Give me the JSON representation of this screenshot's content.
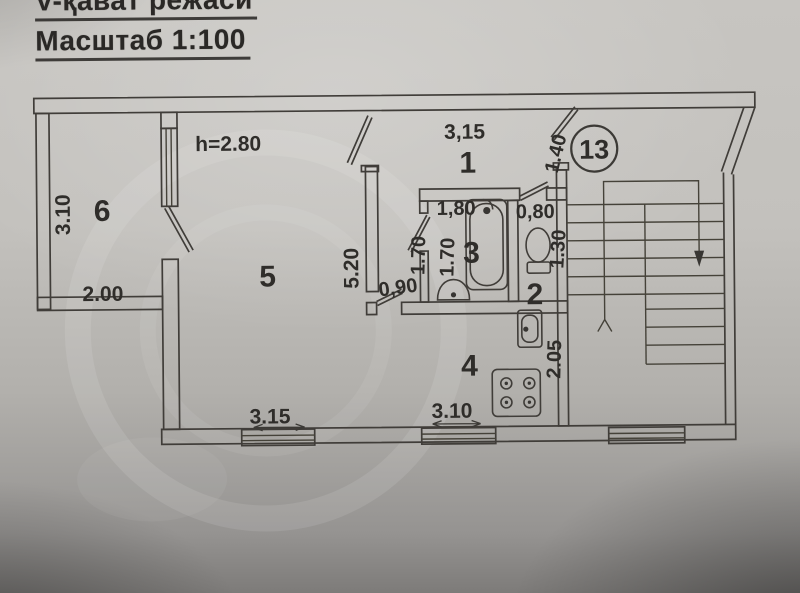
{
  "title": {
    "line1": "V-қават режаси",
    "line2": "Масштаб 1:100"
  },
  "apartment": {
    "number": "13",
    "ceiling_height": "h=2.80"
  },
  "room_numbers": {
    "hall": "1",
    "wc": "2",
    "bathroom": "3",
    "kitchen": "4",
    "living_room": "5",
    "balcony": "6"
  },
  "dimensions": {
    "balcony_depth": "3.10",
    "balcony_width": "2.00",
    "living_room_window": "3.15",
    "living_room_wall": "5.20",
    "hall_width": "3,15",
    "entrance_door": "1.40",
    "kitchen_door": "0,90",
    "corridor_width": "1.70",
    "bathroom_width": "1.70",
    "bathtub_length": "1,80",
    "wc_width": "0,80",
    "wc_depth": "1.30",
    "kitchen_window": "3.10",
    "kitchen_depth": "2.05"
  },
  "icons": [
    "bathtub",
    "washbasin",
    "toilet",
    "kitchen-sink",
    "stove-burners",
    "staircase-down-arrow",
    "window",
    "door-leaf"
  ],
  "colors": {
    "paper": "#c2c0bc",
    "ink": "#3e3b37"
  }
}
